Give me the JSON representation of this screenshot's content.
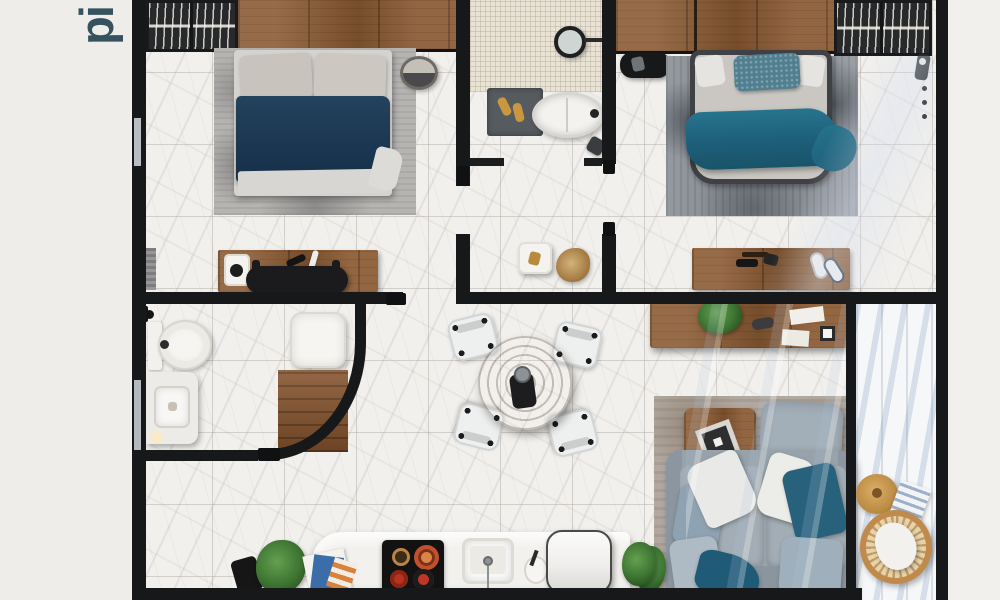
{
  "watermark": {
    "text": "pi",
    "color": "#35525e"
  },
  "scene": {
    "type": "apartment floor plan, top-down 3D render",
    "style": "photorealistic, marble floors, black walls, wood and teal accents"
  },
  "palette": {
    "background": "#efede9",
    "walls": "#17181a",
    "marble_floor": "#f2f0ed",
    "wood": "#8a5a33",
    "navy_bedding": "#1e3c58",
    "teal_bedding": "#216781",
    "sofa_gray": "#97a2aa",
    "plant_green": "#3c7331",
    "pot_red": "#c03526",
    "rattan": "#bf8a4c"
  },
  "rooms": [
    {
      "id": "bedroom-left",
      "label": "Bedroom 1 (top left)",
      "furniture": [
        "wire closet",
        "wood wardrobe",
        "double bed with navy duvet",
        "gray area rug",
        "round basket",
        "wooden desk with coffee machine",
        "black desk chair",
        "radiator"
      ]
    },
    {
      "id": "bathroom-top",
      "label": "Bathroom (top middle)",
      "furniture": [
        "mosaic tile floor",
        "round mirror",
        "dark bath mat with gold slippers",
        "oval bathtub with faucet"
      ]
    },
    {
      "id": "hallway",
      "label": "Hallway (middle)",
      "furniture": [
        "white side table",
        "dried plant"
      ]
    },
    {
      "id": "bedroom-right",
      "label": "Bedroom 2 (top right)",
      "furniture": [
        "wood wardrobe",
        "wire closet",
        "black bench",
        "double bed with teal duvet and knit pillow",
        "dark gray rug",
        "wall hooks",
        "coat stand",
        "wooden desk",
        "white sneakers"
      ]
    },
    {
      "id": "bathroom-2",
      "label": "Bathroom 2 (bottom left)",
      "furniture": [
        "towel bar",
        "toilet",
        "vanity with square sink",
        "shower tray",
        "wooden shower floor",
        "curved black shower wall"
      ]
    },
    {
      "id": "living-dining",
      "label": "Living / dining room (bottom center)",
      "furniture": [
        "round wooden dining table",
        "four white dining chairs",
        "wooden sideboard with plant and papers",
        "gray area rug",
        "wooden coffee table with picture frame",
        "large floor cushion",
        "gray sofa with white and teal pillows",
        "potted plant"
      ]
    },
    {
      "id": "kitchen",
      "label": "Kitchen (bottom center)",
      "furniture": [
        "white counter with rounded end",
        "magazines",
        "black cooktop with red pots",
        "sink with faucet",
        "coffee cup",
        "white refrigerator",
        "potted plants",
        "black stool"
      ]
    },
    {
      "id": "balcony",
      "label": "Balcony (right)",
      "furniture": [
        "sunlit striped floor",
        "round wooden stool",
        "magazine",
        "round rattan chair with white cushion"
      ]
    }
  ]
}
